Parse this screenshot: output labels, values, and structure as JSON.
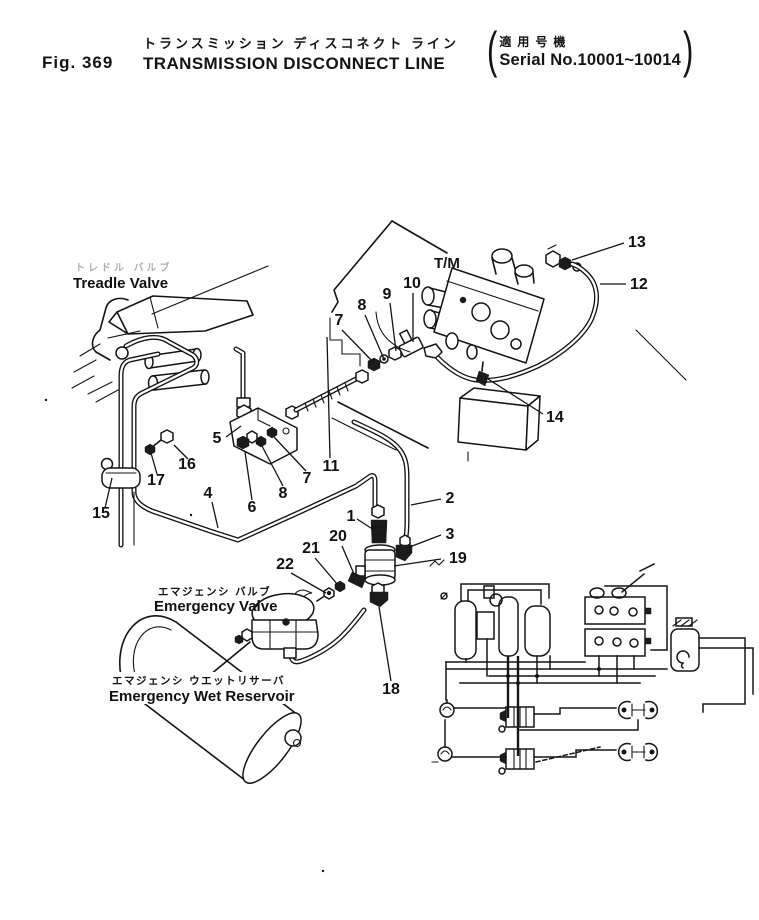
{
  "header": {
    "fig_label": "Fig. 369",
    "title_jp": "トランスミッション  ディスコネクト  ライン",
    "title_en": "TRANSMISSION  DISCONNECT  LINE",
    "serial_jp": "適用号機",
    "serial_en": "Serial No.10001~10014",
    "paren_open": "(",
    "paren_close": ")"
  },
  "labels": {
    "treadle_valve_jp": "トレドル バルブ",
    "treadle_valve": "Treadle Valve",
    "tm": "T/M",
    "emergency_valve_jp": "エマジェンシ バルブ",
    "emergency_valve": "Emergency Valve",
    "emergency_wet_reservoir_jp": "エマジェンシ ウエットリサーバ",
    "emergency_wet_reservoir": "Emergency Wet Reservoir"
  },
  "callouts": [
    {
      "n": "1",
      "x": 351,
      "y": 521,
      "x1": 357,
      "y1": 519,
      "x2": 374,
      "y2": 530
    },
    {
      "n": "2",
      "x": 450,
      "y": 503,
      "x1": 441,
      "y1": 499,
      "x2": 411,
      "y2": 505
    },
    {
      "n": "3",
      "x": 450,
      "y": 539,
      "x1": 441,
      "y1": 535,
      "x2": 407,
      "y2": 548
    },
    {
      "n": "4",
      "x": 208,
      "y": 498,
      "x1": 212,
      "y1": 502,
      "x2": 218,
      "y2": 528
    },
    {
      "n": "5",
      "x": 217,
      "y": 443,
      "x1": 226,
      "y1": 437,
      "x2": 241,
      "y2": 426
    },
    {
      "n": "6",
      "x": 252,
      "y": 512,
      "x1": 252,
      "y1": 500,
      "x2": 245,
      "y2": 452
    },
    {
      "n": "7",
      "x": 339,
      "y": 325,
      "x1": 342,
      "y1": 330,
      "x2": 374,
      "y2": 363
    },
    {
      "n": "8",
      "x": 362,
      "y": 310,
      "x1": 365,
      "y1": 315,
      "x2": 384,
      "y2": 359
    },
    {
      "n": "9",
      "x": 387,
      "y": 299,
      "x1": 390,
      "y1": 303,
      "x2": 396,
      "y2": 351
    },
    {
      "n": "10",
      "x": 412,
      "y": 288,
      "x1": 413,
      "y1": 293,
      "x2": 413,
      "y2": 342
    },
    {
      "n": "11",
      "x": 331,
      "y": 471,
      "x1": 330,
      "y1": 458,
      "x2": 327,
      "y2": 337
    },
    {
      "n": "12",
      "x": 630,
      "y": 289,
      "x1": 626,
      "y1": 284,
      "x2": 600,
      "y2": 284,
      "anchor": "start"
    },
    {
      "n": "13",
      "x": 628,
      "y": 247,
      "x1": 624,
      "y1": 243,
      "x2": 572,
      "y2": 260,
      "anchor": "start"
    },
    {
      "n": "14",
      "x": 546,
      "y": 422,
      "x1": 543,
      "y1": 414,
      "x2": 488,
      "y2": 379,
      "anchor": "start"
    },
    {
      "n": "15",
      "x": 101,
      "y": 518,
      "x1": 105,
      "y1": 508,
      "x2": 112,
      "y2": 478
    },
    {
      "n": "16",
      "x": 187,
      "y": 469,
      "x1": 188,
      "y1": 459,
      "x2": 174,
      "y2": 445
    },
    {
      "n": "17",
      "x": 156,
      "y": 485,
      "x1": 157,
      "y1": 474,
      "x2": 151,
      "y2": 453
    },
    {
      "n": "18",
      "x": 391,
      "y": 694,
      "x1": 391,
      "y1": 681,
      "x2": 379,
      "y2": 607
    },
    {
      "n": "19",
      "x": 449,
      "y": 563,
      "x1": 441,
      "y1": 559,
      "x2": 394,
      "y2": 566,
      "anchor": "start"
    },
    {
      "n": "20",
      "x": 338,
      "y": 541,
      "x1": 342,
      "y1": 546,
      "x2": 354,
      "y2": 574
    },
    {
      "n": "21",
      "x": 311,
      "y": 553,
      "x1": 315,
      "y1": 558,
      "x2": 338,
      "y2": 585
    },
    {
      "n": "22",
      "x": 285,
      "y": 569,
      "x1": 291,
      "y1": 573,
      "x2": 326,
      "y2": 593
    },
    {
      "n": "7",
      "x": 307,
      "y": 483,
      "x1": 306,
      "y1": 471,
      "x2": 274,
      "y2": 437
    },
    {
      "n": "8",
      "x": 283,
      "y": 498,
      "x1": 283,
      "y1": 486,
      "x2": 262,
      "y2": 446
    }
  ]
}
